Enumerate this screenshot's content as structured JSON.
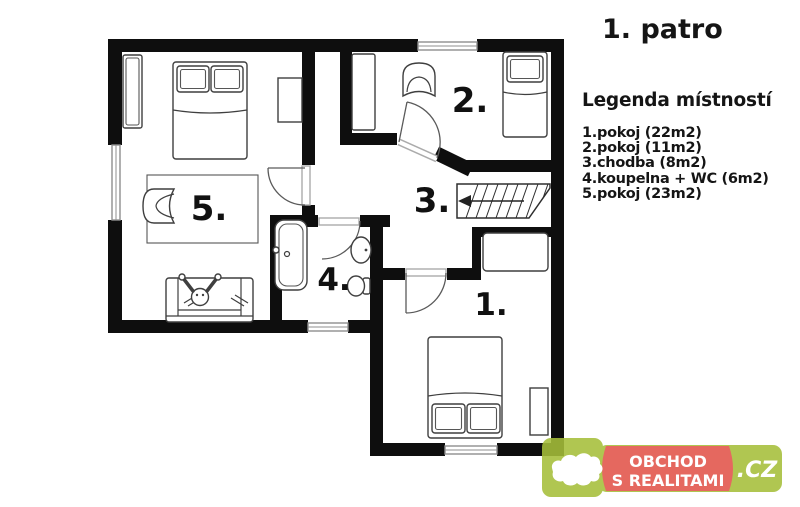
{
  "title": "1. patro",
  "legend": {
    "heading": "Legenda místností",
    "items": [
      {
        "label": "1.pokoj (22m2)"
      },
      {
        "label": "2.pokoj (11m2)"
      },
      {
        "label": "3.chodba (8m2)"
      },
      {
        "label": "4.koupelna + WC (6m2)"
      },
      {
        "label": "5.pokoj (23m2)"
      }
    ]
  },
  "plan": {
    "room_labels": [
      {
        "id": "room-1",
        "label": "1."
      },
      {
        "id": "room-2",
        "label": "2."
      },
      {
        "id": "room-3",
        "label": "3."
      },
      {
        "id": "room-4",
        "label": "4."
      },
      {
        "id": "room-5",
        "label": "5."
      }
    ]
  },
  "watermark": {
    "line1": "OBCHOD",
    "line2": "S REALITAMI",
    "tld": ".CZ",
    "green_color": "#a6bf3a",
    "red_color": "#e2544a",
    "text_color": "#ffffff"
  }
}
